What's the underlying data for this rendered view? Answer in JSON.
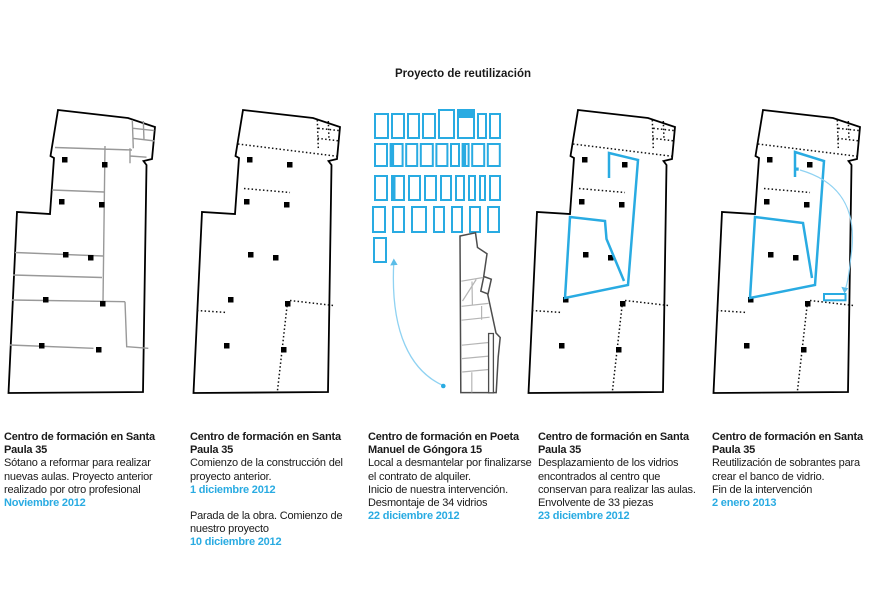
{
  "title": "Proyecto de reutilización",
  "colors": {
    "accent_blue": "#29abe2",
    "light_blue_arc": "#8fd2f2",
    "arrowhead_blue": "#5bbde8",
    "plan_outline": "#000000",
    "interior_gray": "#999999",
    "plan3_dark": "#4d4d4d",
    "plan3_light": "#b5b5b5",
    "text": "#1a1a1a"
  },
  "panels": [
    {
      "heading": "Centro de formación en Santa\nPaula 35",
      "paragraphs": [
        {
          "text": "Sótano a reformar para realizar nuevas aulas. Proyecto anterior realizado por otro profesional",
          "date": "Noviembre 2012"
        }
      ]
    },
    {
      "heading": "Centro de formación en Santa\nPaula 35",
      "paragraphs": [
        {
          "text": "Comienzo de la construcción del proyecto anterior.",
          "date": "1 diciembre 2012"
        },
        {
          "text": "Parada de la obra. Comienzo de nuestro proyecto",
          "date": "10 diciembre 2012"
        }
      ]
    },
    {
      "heading": "Centro de formación en Poeta\nManuel de Góngora 15",
      "paragraphs": [
        {
          "text": "Local a desmantelar por finalizarse el contrato de alquiler.\nInicio de nuestra intervención.\nDesmontaje de 34 vidrios",
          "date": "22 diciembre 2012"
        }
      ]
    },
    {
      "heading": "Centro de formación en Santa\nPaula 35",
      "paragraphs": [
        {
          "text": "Desplazamiento de los vidrios encontrados al centro que conservan para realizar las aulas.\nEnvolvente de 33 piezas",
          "date": "23 diciembre 2012"
        }
      ]
    },
    {
      "heading": "Centro de formación en Santa\nPaula 35",
      "paragraphs": [
        {
          "text": "Reutilización de sobrantes para crear el banco de vidrio.\nFin de la intervención",
          "date": "2 enero 2013"
        }
      ]
    }
  ],
  "glass_grid": {
    "count": 34,
    "stroke": "#29abe2",
    "x0": [
      375,
      375,
      375,
      373,
      374
    ],
    "row_y": [
      114,
      144,
      176,
      207,
      238
    ],
    "row_h": [
      24,
      22,
      24,
      25,
      24
    ],
    "gap": [
      4,
      3.6,
      5,
      8,
      0
    ],
    "rows": [
      [
        13,
        12,
        11,
        12,
        15,
        16,
        8,
        10
      ],
      [
        12,
        12,
        11,
        12,
        11,
        8,
        6,
        12,
        12
      ],
      [
        12,
        12,
        11,
        11,
        10,
        8,
        6,
        5,
        10
      ],
      [
        12,
        11,
        14,
        10,
        10,
        10,
        11
      ],
      [
        12
      ]
    ],
    "specials": [
      {
        "row": 0,
        "idx": 4,
        "taller": 4
      },
      {
        "row": 0,
        "idx": 5,
        "taller": 4,
        "filled_top": 8
      },
      {
        "row": 1,
        "idx": 1,
        "thick_left": true
      },
      {
        "row": 1,
        "idx": 6,
        "thick_left": true
      },
      {
        "row": 2,
        "idx": 1,
        "thick_left": true
      }
    ]
  }
}
